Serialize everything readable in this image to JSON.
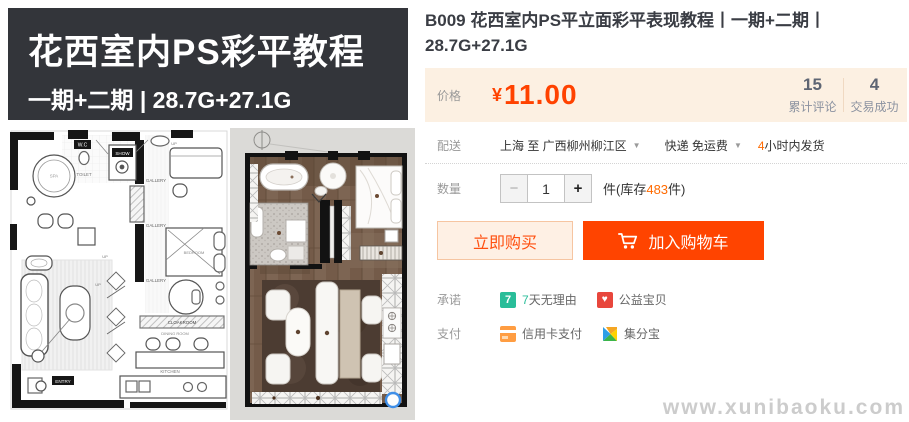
{
  "colors": {
    "accent": "#ff4400",
    "price_text": "#ff4200",
    "price_box_bg": "#fcf0e2",
    "banner_bg": "#33353a",
    "banner_underline": "#f2a42c",
    "promise_green": "#29bd99",
    "charity_red": "#e8463c",
    "credit_card_orange": "#ff9d42"
  },
  "gallery": {
    "banner": {
      "title": "花西室内PS彩平教程",
      "subtitle": "一期+二期 | 28.7G+27.1G"
    },
    "plan_labels": {
      "spa": "SPA",
      "wc": "W.C",
      "toilet": "TOILET",
      "show": "SHOW",
      "gallery": "GALLERY",
      "bedroom": "BEDROOM",
      "cloakroom": "CLOAKROOM",
      "dining_room": "DINING ROOM",
      "kitchen": "KITCHEN",
      "entry": "ENTRY",
      "up": "UP"
    }
  },
  "product": {
    "title": "B009 花西室内PS平立面彩平表现教程丨一期+二期丨28.7G+27.1G",
    "price": {
      "label": "价格",
      "currency": "¥",
      "amount": "11.00"
    },
    "stats": [
      {
        "value": "15",
        "label": "累计评论"
      },
      {
        "value": "4",
        "label": "交易成功"
      }
    ],
    "shipping": {
      "label": "配送",
      "route": "上海 至  广西柳州柳江区",
      "method": "快递 免运费",
      "promise_highlight": "4",
      "promise_rest": "小时内发货",
      "caret": "▼"
    },
    "quantity": {
      "label": "数量",
      "minus": "−",
      "value": "1",
      "plus": "+",
      "stock_prefix": "件(库存",
      "stock_count": "483",
      "stock_suffix": "件)"
    },
    "actions": {
      "buy_now": "立即购买",
      "add_to_cart": "加入购物车"
    },
    "promise": {
      "label": "承诺",
      "items": [
        {
          "icon": "seven-day-icon",
          "icon_glyph": "7",
          "text_highlight": "7",
          "text_rest": "天无理由"
        },
        {
          "icon": "charity-heart-icon",
          "icon_glyph": "♥",
          "text": "公益宝贝"
        }
      ]
    },
    "payment": {
      "label": "支付",
      "items": [
        {
          "icon": "credit-card-icon",
          "text": "信用卡支付"
        },
        {
          "icon": "jifenbao-icon",
          "text": "集分宝"
        }
      ]
    }
  },
  "watermark": "www.xunibaoku.com"
}
